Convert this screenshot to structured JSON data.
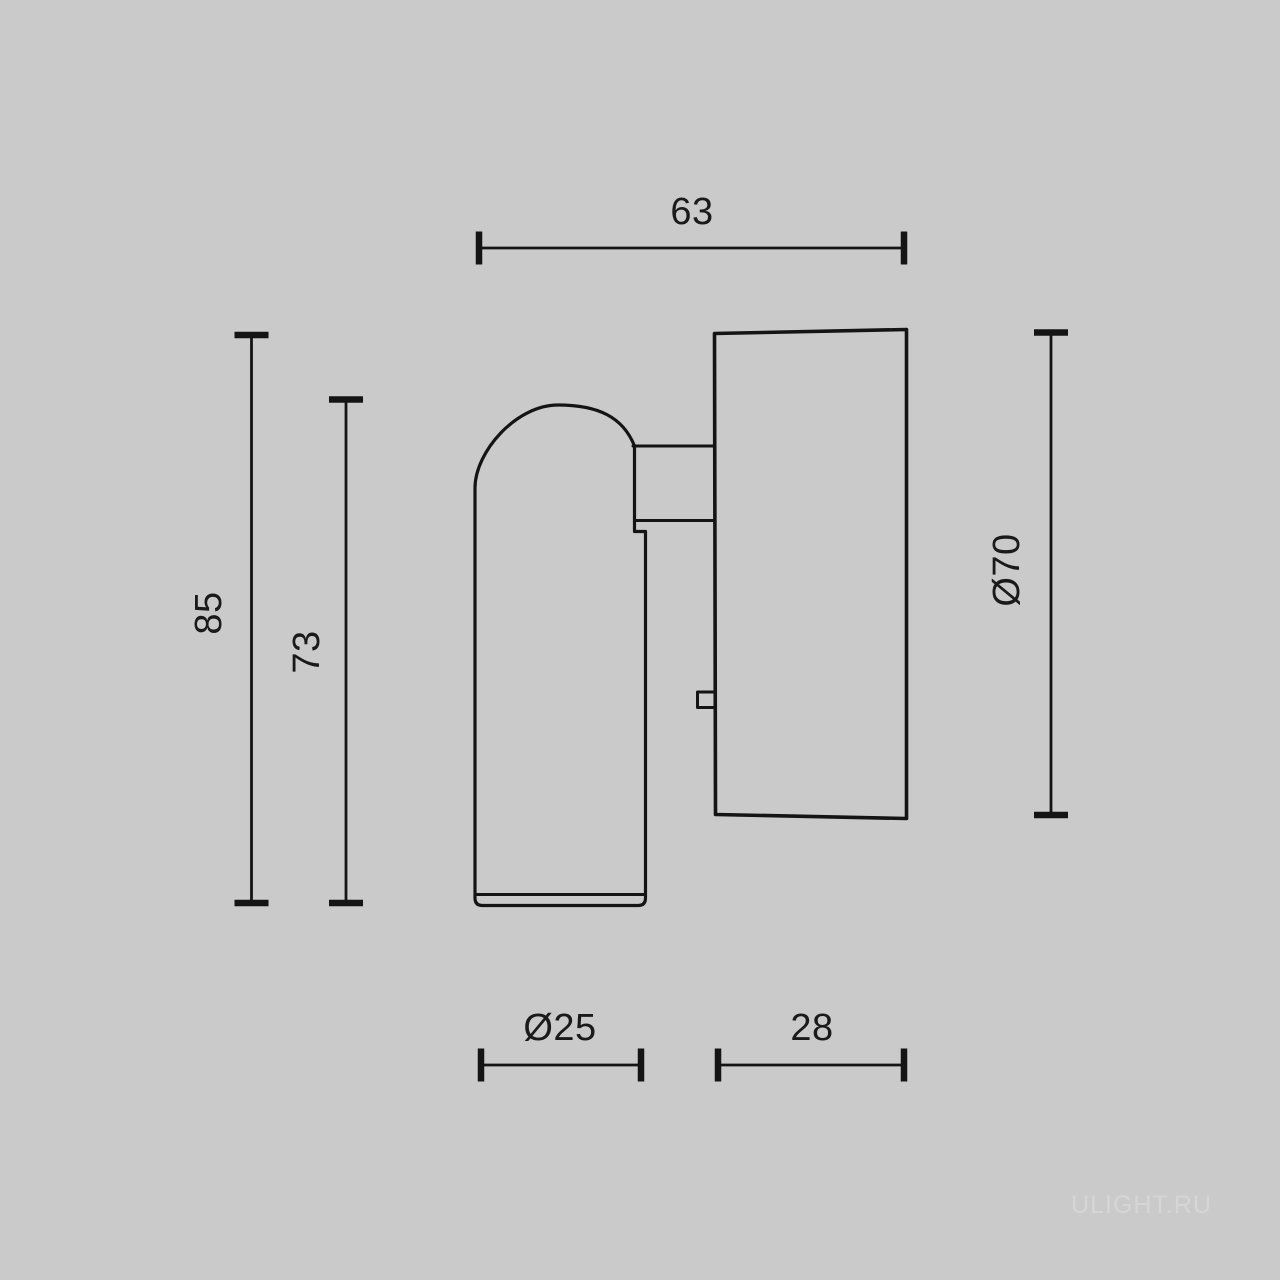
{
  "page": {
    "background_color": "#cacaca",
    "line_color": "#141414",
    "watermark": "ULIGHT.RU",
    "watermark_color": "#d6d6d6"
  },
  "dimensions": {
    "top_width": "63",
    "overall_height": "85",
    "head_height": "73",
    "plate_diameter": "Ø70",
    "head_diameter": "Ø25",
    "plate_depth": "28"
  }
}
